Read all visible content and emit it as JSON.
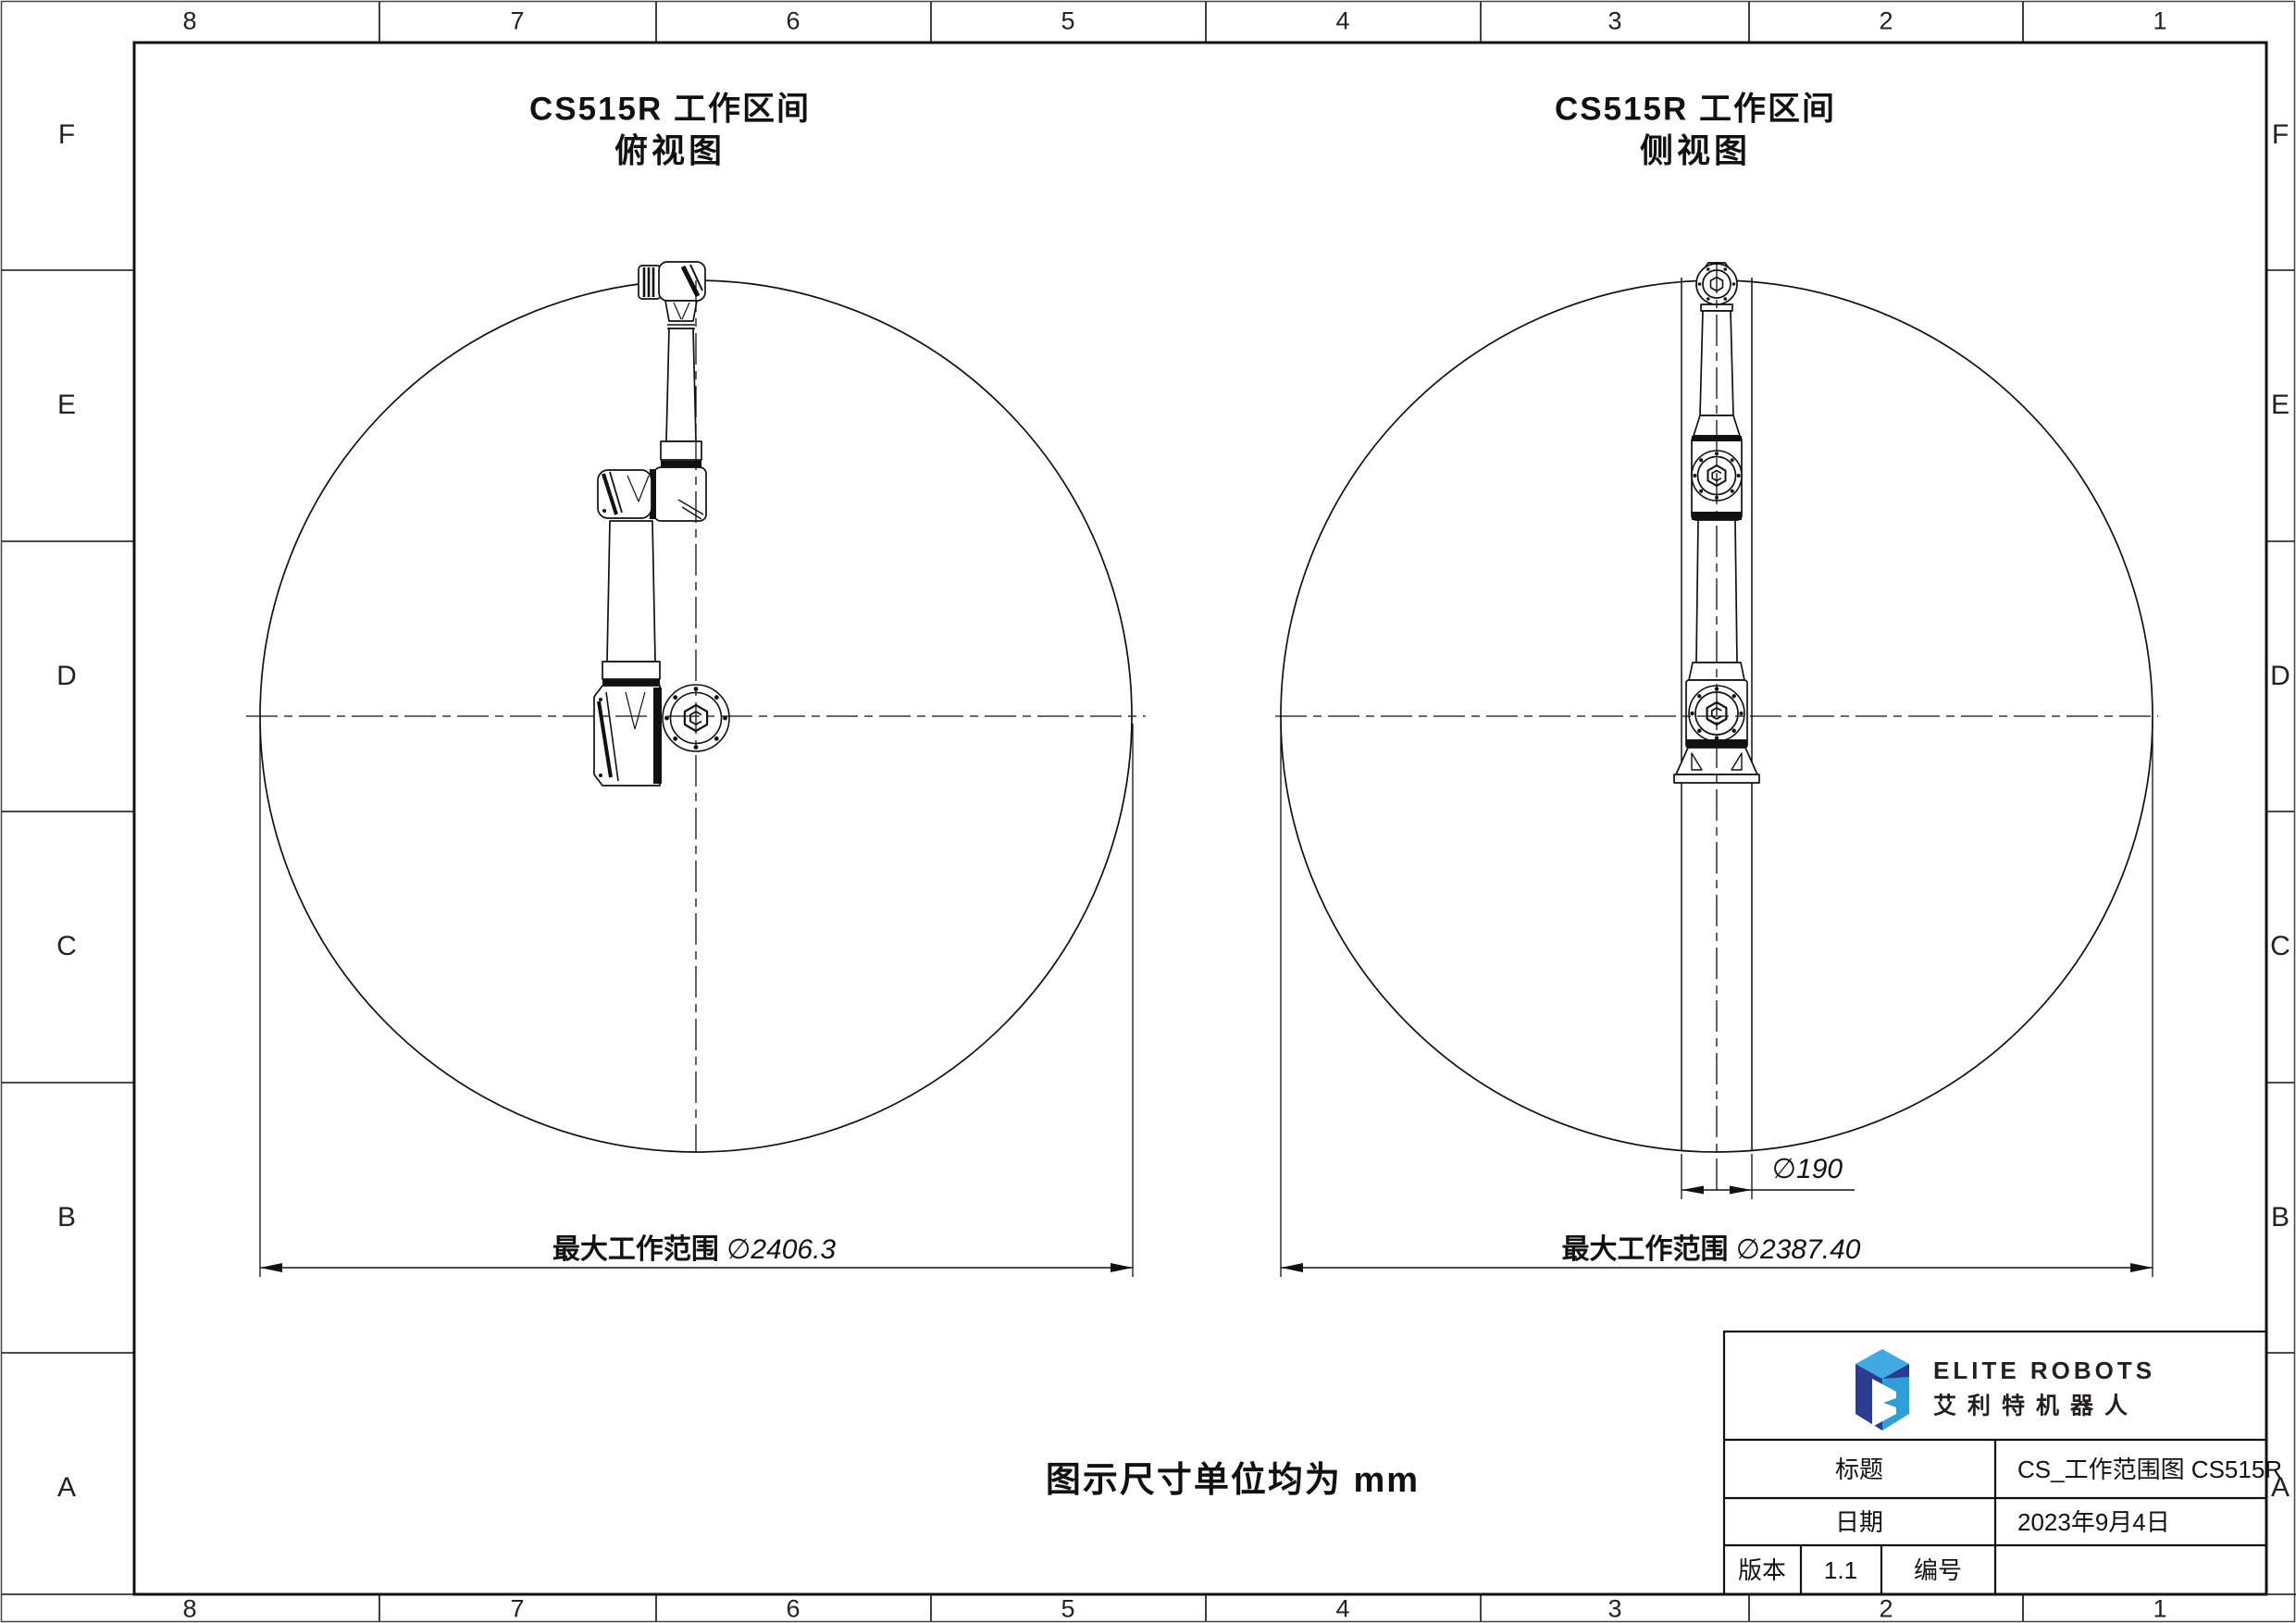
{
  "border": {
    "columns": [
      "8",
      "7",
      "6",
      "5",
      "4",
      "3",
      "2",
      "1"
    ],
    "rows": [
      "F",
      "E",
      "D",
      "C",
      "B",
      "A"
    ]
  },
  "top_view": {
    "title": "CS515R 工作区间",
    "subtitle": "俯视图",
    "dim_label": "最大工作范围",
    "dim_value": "∅2406.3"
  },
  "side_view": {
    "title": "CS515R 工作区间",
    "subtitle": "侧视图",
    "dim_label": "最大工作范围",
    "dim_value": "∅2387.40",
    "column_dim_value": "∅190"
  },
  "note": "图示尺寸单位均为 mm",
  "title_block": {
    "brand_en": "ELITE ROBOTS",
    "brand_cn": "艾利特机器人",
    "title_label": "标题",
    "title_value": "CS_工作范围图 CS515R",
    "date_label": "日期",
    "date_value": "2023年9月4日",
    "version_label": "版本",
    "version_value": "1.1",
    "number_label": "编号",
    "number_value": ""
  },
  "colors": {
    "line": "#111111",
    "logo_light_blue": "#41AAE2",
    "logo_navy": "#2A3B90",
    "logo_cyan": "#2F9FD8"
  }
}
